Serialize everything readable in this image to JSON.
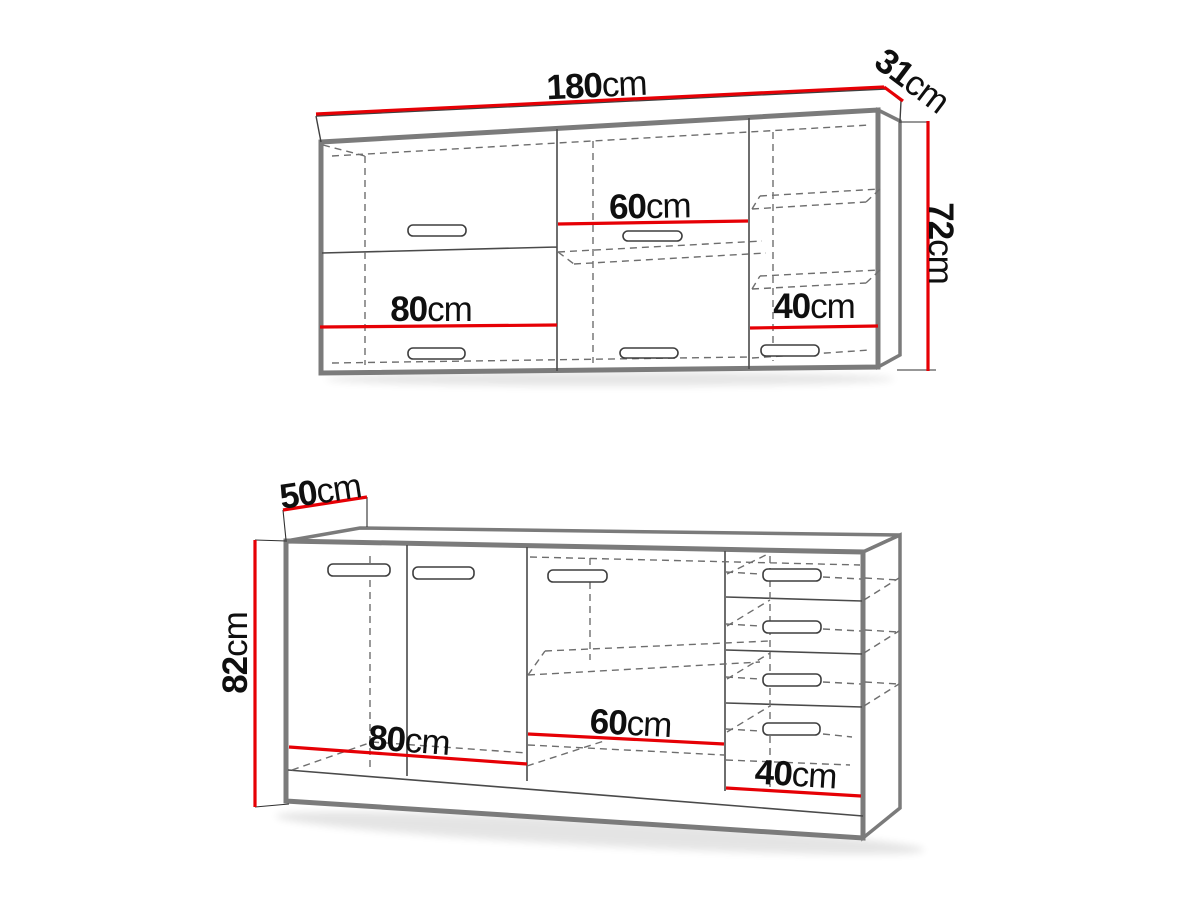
{
  "diagram": {
    "accent_color": "#e60005",
    "outline_color": "#7b7b7b",
    "top": {
      "width": {
        "value": "180",
        "unit": "cm"
      },
      "depth": {
        "value": "31",
        "unit": "cm"
      },
      "height": {
        "value": "72",
        "unit": "cm"
      },
      "section_left": {
        "value": "80",
        "unit": "cm"
      },
      "section_middle": {
        "value": "60",
        "unit": "cm"
      },
      "section_right": {
        "value": "40",
        "unit": "cm"
      }
    },
    "bottom": {
      "depth": {
        "value": "50",
        "unit": "cm"
      },
      "height": {
        "value": "82",
        "unit": "cm"
      },
      "section_left": {
        "value": "80",
        "unit": "cm"
      },
      "section_middle": {
        "value": "60",
        "unit": "cm"
      },
      "section_right": {
        "value": "40",
        "unit": "cm"
      }
    }
  }
}
